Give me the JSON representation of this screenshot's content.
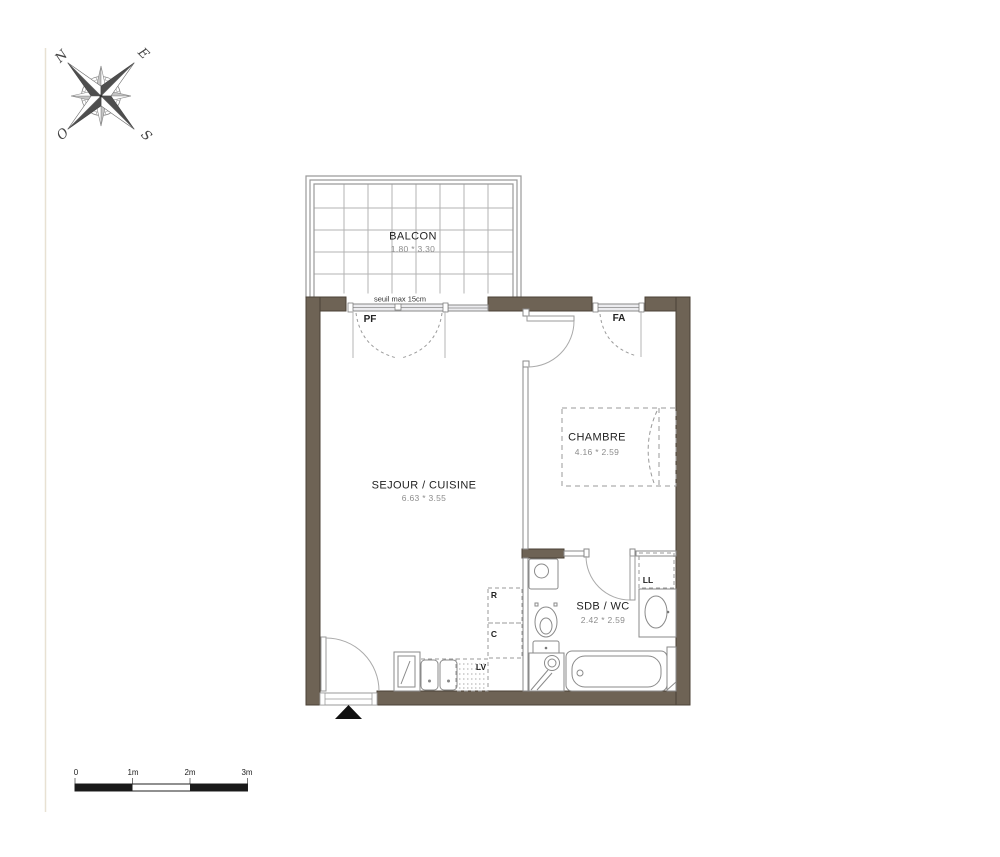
{
  "plan": {
    "balcon": {
      "name": "BALCON",
      "dims": "1.80 * 3.30"
    },
    "sejour": {
      "name": "SEJOUR / CUISINE",
      "dims": "6.63 * 3.55"
    },
    "chambre": {
      "name": "CHAMBRE",
      "dims": "4.16 * 2.59"
    },
    "sdb": {
      "name": "SDB / WC",
      "dims": "2.42 * 2.59"
    },
    "labels": {
      "seuil": "seuil max 15cm",
      "pf": "PF",
      "fa": "FA",
      "ll": "LL",
      "r": "R",
      "c": "C",
      "lv": "LV"
    }
  },
  "compass": {
    "north": "N",
    "east": "E",
    "south": "S",
    "west": "O"
  },
  "scale_bar": {
    "tick0": "0",
    "tick1": "1m",
    "tick2": "2m",
    "tick3": "3m"
  },
  "colors": {
    "wall": "#6e6355",
    "wall_edge": "#4b4236",
    "thin_line": "#8a8a8a",
    "glass": "#ececef",
    "text": "#1f1f1f",
    "dim_text": "#8c8c8c",
    "entrance_marker": "#111111"
  }
}
